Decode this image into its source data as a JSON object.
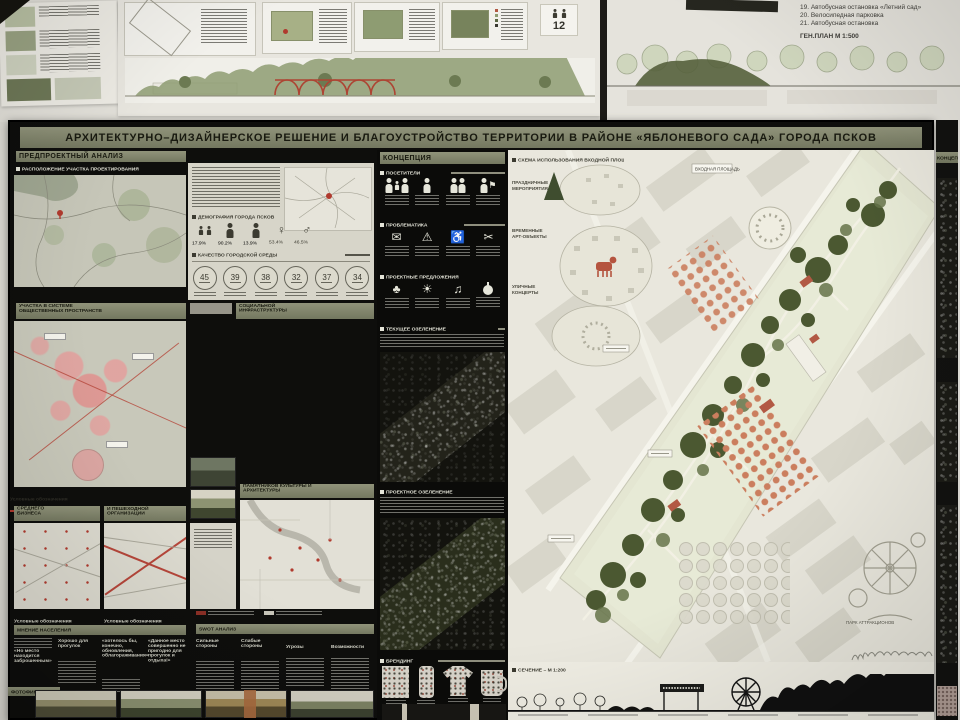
{
  "title": "АРХИТЕКТУРНО–ДИЗАЙНЕРСКОЕ РЕШЕНИЕ И БЛАГОУСТРОЙСТВО ТЕРРИТОРИИ В РАЙОНЕ «ЯБЛОНЕВОГО САДА» ГОРОДА ПСКОВ",
  "top_boards": {
    "notes": [
      "19. Автобусная остановка «Летний сад»",
      "20. Велосипедная парковка",
      "21. Автобусная остановка"
    ],
    "scale_label": "ГЕН.ПЛАН М 1:500",
    "badge": "12"
  },
  "analysis": {
    "header": "ПРЕДПРОЕКТНЫЙ АНАЛИЗ",
    "location_header": "РАСПОЛОЖЕНИЕ УЧАСТКА ПРОЕКТИРОВАНИЯ",
    "demography": {
      "header": "ДЕМОГРАФИЯ ГОРОДА ПСКОВ",
      "values": [
        "17.9%",
        "90.2%",
        "13.9%",
        "53.4%",
        "46.5%"
      ],
      "female_symbol": "♀",
      "male_symbol": "♂"
    },
    "quality": {
      "header": "КАЧЕСТВО ГОРОДСКОЙ СРЕДЫ",
      "scores": [
        "45",
        "39",
        "38",
        "32",
        "37",
        "34"
      ]
    },
    "maps": {
      "public_spaces": "КАРТА-СХЕМА РАСПОЛОЖЕНИЯ УЧАСТКА В СИСТЕМЕ ОБЩЕСТВЕННЫХ ПРОСТРАНСТВ",
      "social_infrastructure": "КАРТА-СХЕМА РАСПОЛОЖЕНИЯ ОБЪЕКТОВ СОЦИАЛЬНОЙ ИНФРАСТРУКТУРЫ",
      "culture_monuments": "КАРТА-СХЕМА РАСПОЛОЖЕНИЯ ПАМЯТНИКОВ КУЛЬТУРЫ И АРХИТЕКТУРЫ",
      "small_business": "КАРТА-СХЕМА РАСПОЛОЖЕНИЯ МАЛОГО И СРЕДНЕГО БИЗНЕСА",
      "transport": "КАРТА-СХЕМА ТРАНСПОРТНОЙ И ПЕШЕХОДНОЙ ОРГАНИЗАЦИИ"
    },
    "legend_label": "Условные обозначения",
    "opinion": {
      "header": "МНЕНИЕ НАСЕЛЕНИЯ",
      "quotes": [
        "«Но место находится заброшенным»",
        "Хорошо для прогулок",
        "«хотелось бы, конечно, обновления, облагораживания»",
        "«Данное место совершенно не пригодно для прогулок и отдыха!»"
      ]
    },
    "swot": {
      "header": "SWOT АНАЛИЗ",
      "columns": [
        "Сильные стороны",
        "Слабые стороны",
        "Угрозы",
        "Возможности"
      ]
    },
    "photos_header": "ФОТОФИКСАЦИЯ УЧАСТКА"
  },
  "concept": {
    "header": "КОНЦЕПЦИЯ",
    "visitors_header": "ПОСЕТИТЕЛИ",
    "problems_header": "ПРОБЛЕМАТИКА",
    "proposals_header": "ПРОЕКТНЫЕ ПРЕДЛОЖЕНИЯ",
    "current_greenery_header": "ТЕКУЩЕЕ ОЗЕЛЕНЕНИЕ",
    "project_greenery_header": "ПРОЕКТНОЕ ОЗЕЛЕНЕНИЕ",
    "branding_header": "БРЕНДИНГ"
  },
  "masterplan": {
    "scheme_header": "СХЕМА ИСПОЛЬЗОВАНИЯ ВХОДНОЙ ПЛОЩАДИ",
    "bubbles": [
      {
        "l1": "ПРАЗДНИЧНЫЕ",
        "l2": "МЕРОПРИЯТИЯ"
      },
      {
        "l1": "ВРЕМЕННЫЕ",
        "l2": "АРТ-ОБЪЕКТЫ"
      },
      {
        "l1": "УЛИЧНЫЕ",
        "l2": "КОНЦЕРТЫ"
      }
    ],
    "labels": {
      "entrance": "ВХОДНАЯ ПЛОЩАДЬ",
      "attractions": "ПАРК АТТРАКЦИОНОВ"
    },
    "section_header": "СЕЧЕНИЕ – М 1:200"
  },
  "right_board": {
    "header": "КОНЦЕП",
    "sections": [
      "ЛЕТНЯЯ С",
      "ЗИМН",
      "СХЕМА О",
      "ПОКРЫТИЯ"
    ]
  },
  "colors": {
    "board_olive": "#81846a",
    "board_black": "#0d0d0b",
    "accent_red": "#b24a3a",
    "orchard_orange": "#cb7e5e",
    "blob_pink": "#e2a19e"
  }
}
